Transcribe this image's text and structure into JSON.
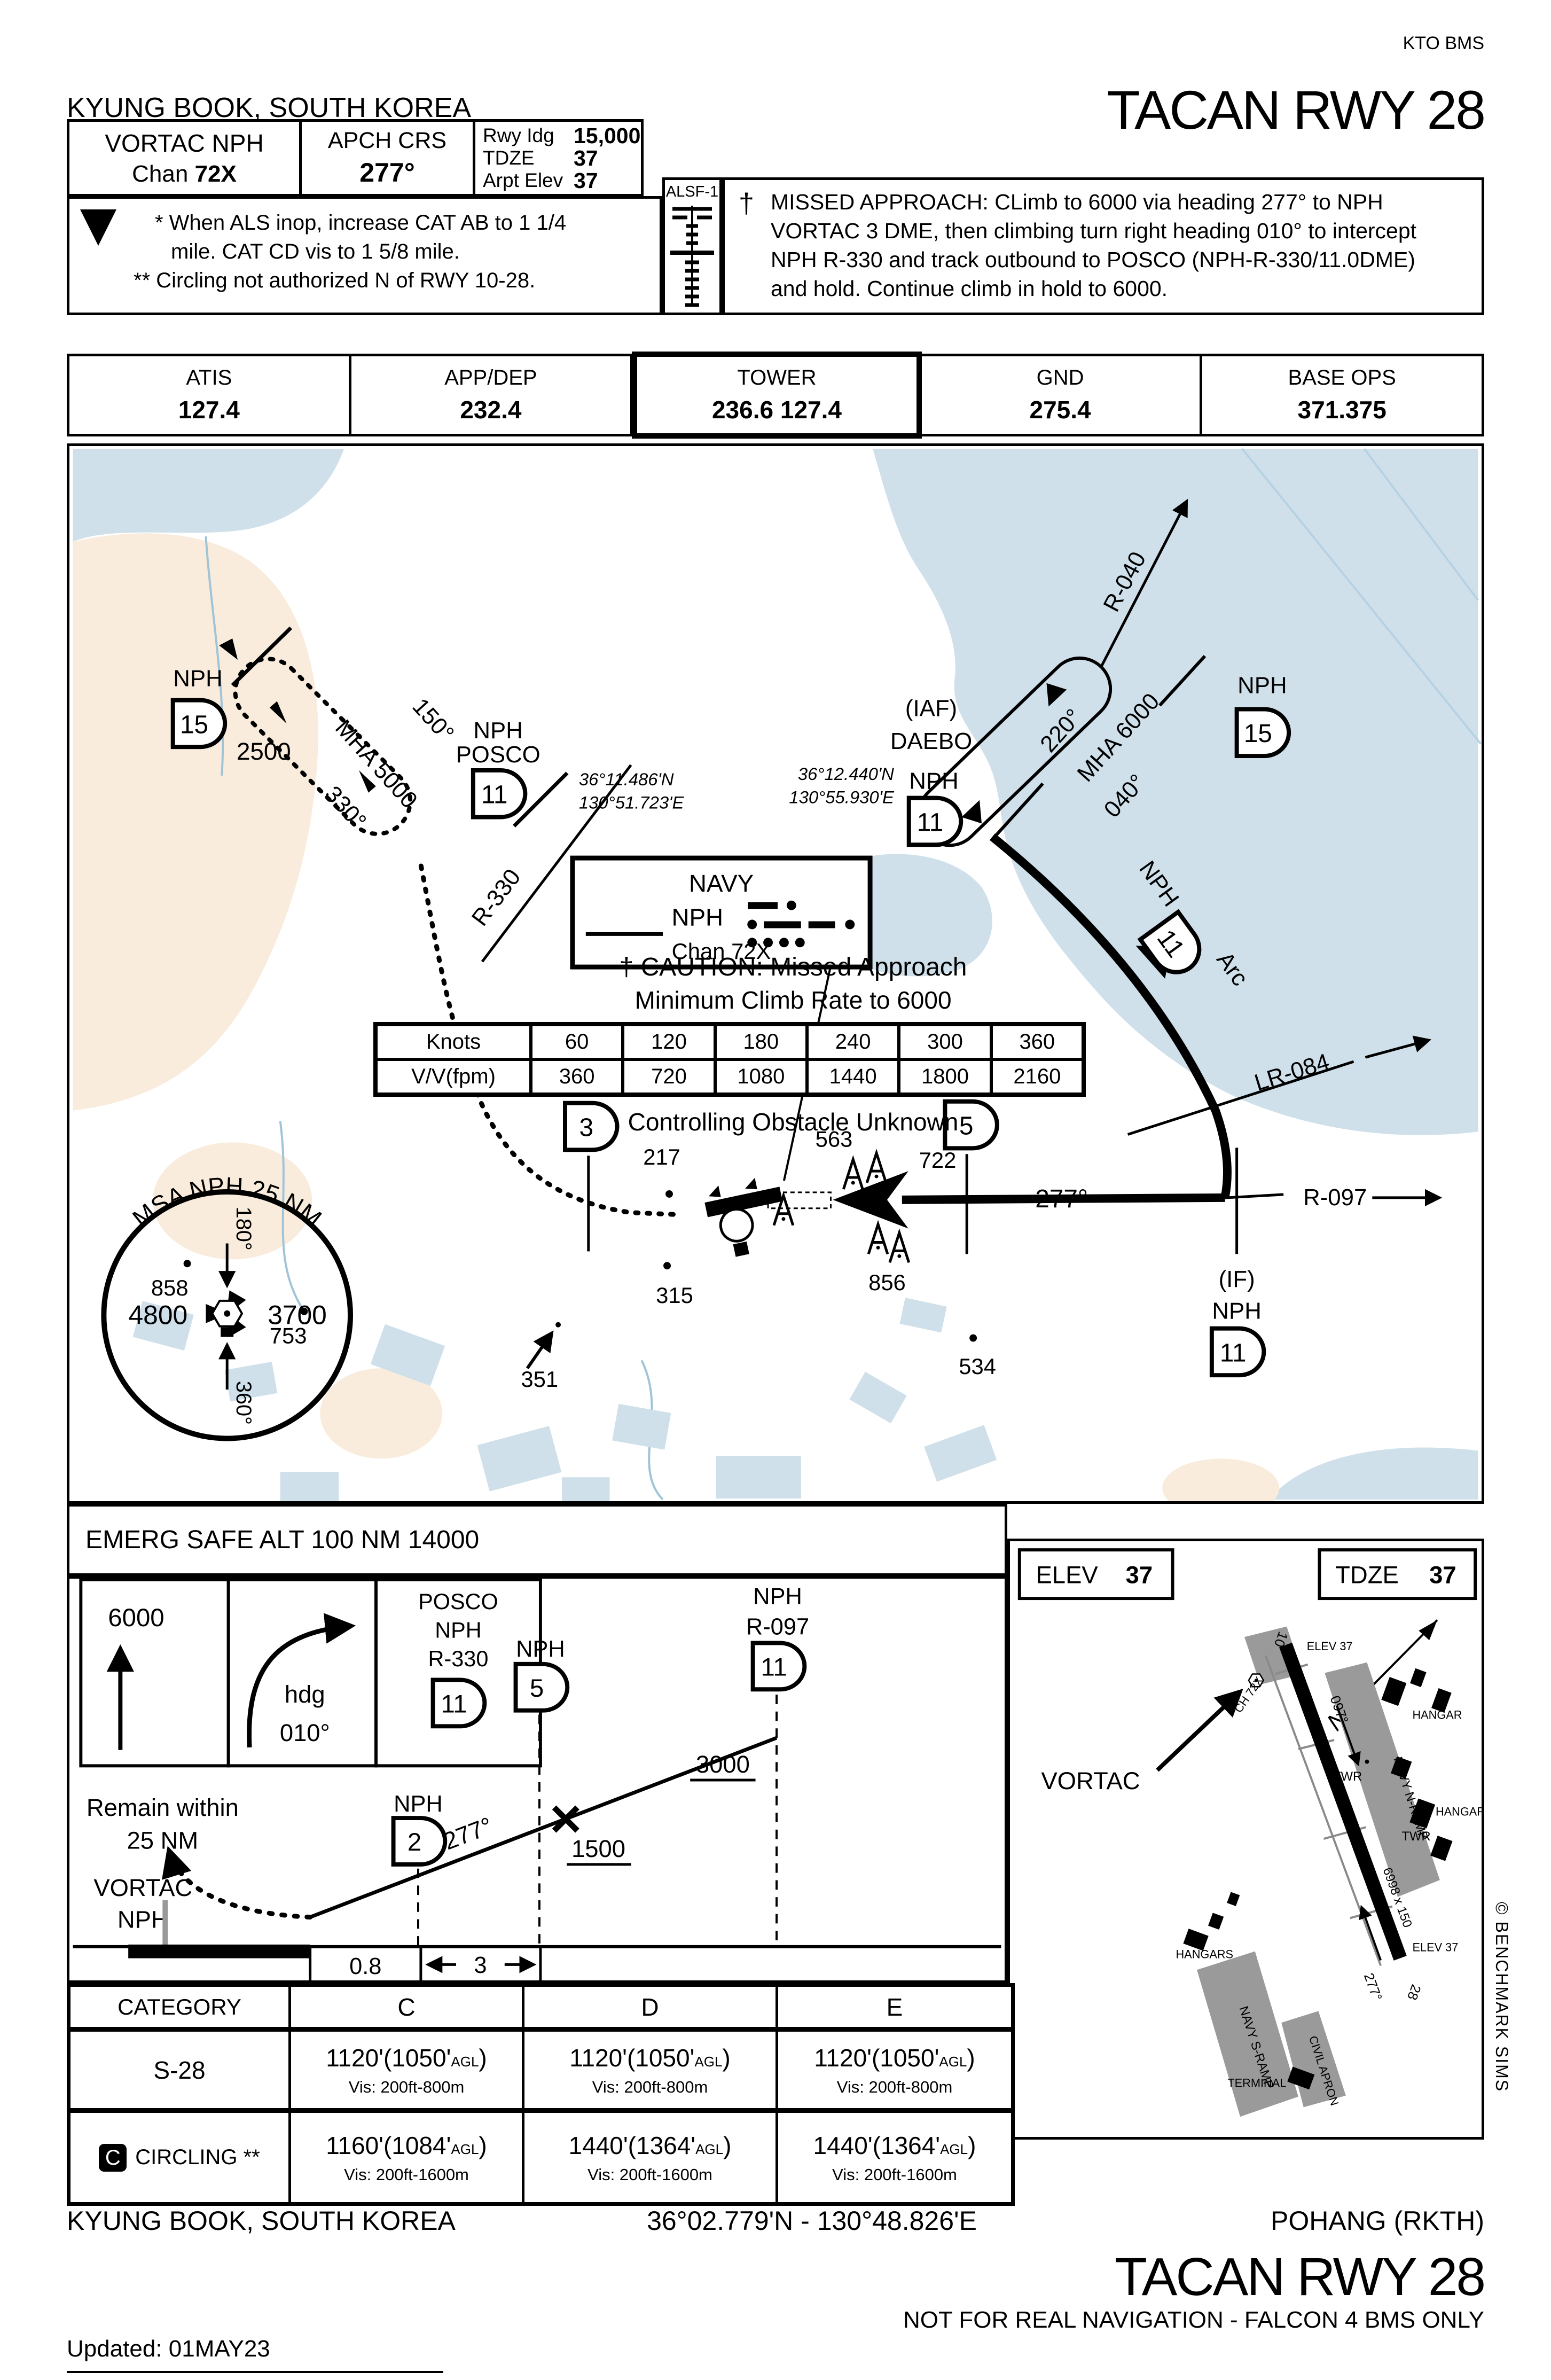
{
  "meta": {
    "kto": "KTO BMS",
    "copyright": "© BENCHMARK SIMS"
  },
  "header": {
    "city": "KYUNG BOOK, SOUTH KOREA",
    "title": "TACAN RWY 28",
    "airport": "POHANG (RKTH)",
    "facility_line1": "VORTAC NPH",
    "chan_label": "Chan",
    "chan_value": "72X",
    "apch_label": "APCH CRS",
    "apch_value": "277°",
    "rwy": {
      "r1l": "Rwy Idg",
      "r1v": "15,000",
      "r2l": "TDZE",
      "r2v": "37",
      "r3l": "Arpt Elev",
      "r3v": "37"
    },
    "notes": {
      "t": "T",
      "n1": "* When ALS inop, increase CAT AB to 1 1/4",
      "n2": "mile. CAT CD vis to 1 5/8 mile.",
      "n3": "** Circling not authorized N of RWY 10-28."
    },
    "alsf": "ALSF-1",
    "missed": {
      "dagger": "†",
      "l1": "MISSED APPROACH: CLimb to 6000 via heading 277° to NPH",
      "l2": "VORTAC 3 DME, then climbing turn right heading 010° to intercept",
      "l3": "NPH R-330 and track outbound to POSCO (NPH-R-330/11.0DME)",
      "l4": "and hold. Continue climb in hold to 6000."
    }
  },
  "freqs": [
    {
      "label": "ATIS",
      "value": "127.4"
    },
    {
      "label": "APP/DEP",
      "value": "232.4"
    },
    {
      "label": "TOWER",
      "value": "236.6   127.4"
    },
    {
      "label": "GND",
      "value": "275.4"
    },
    {
      "label": "BASE OPS",
      "value": "371.375"
    }
  ],
  "plan": {
    "caution1": "† CAUTION: Missed Approach",
    "caution2": "Minimum Climb Rate to 6000",
    "controlling": "Controlling Obstacle Unknown",
    "climb": {
      "knots": [
        "Knots",
        "60",
        "120",
        "180",
        "240",
        "300",
        "360"
      ],
      "vv": [
        "V/V(fpm)",
        "360",
        "720",
        "1080",
        "1440",
        "1800",
        "2160"
      ]
    },
    "holds": {
      "posco": {
        "inb": "150°",
        "mha": "MHA 5000",
        "outb": "330°",
        "alt": "2500"
      },
      "daebo": {
        "inb": "220°",
        "mha": "MHA 6000",
        "outb": "040°"
      }
    },
    "fixes": {
      "nph15L": {
        "name": "NPH",
        "dme": "15"
      },
      "posco": {
        "nph": "NPH",
        "name": "POSCO",
        "dme": "11",
        "lat": "36°11.486'N",
        "lon": "130°51.723'E"
      },
      "daebo": {
        "iaf": "(IAF)",
        "name": "DAEBO",
        "lat": "36°12.440'N",
        "lon": "130°55.930'E",
        "nph": "NPH",
        "dme": "11"
      },
      "nph15R": {
        "name": "NPH",
        "dme": "15"
      },
      "nph3": {
        "name": "NPH",
        "dme": "3"
      },
      "nph5": {
        "name": "NPH",
        "dme": "5"
      },
      "iffix": {
        "tag": "(IF)",
        "nph": "NPH",
        "dme": "11"
      },
      "arc": {
        "nph": "NPH",
        "dme": "11",
        "word": "Arc"
      }
    },
    "radials": {
      "r040": "R-040",
      "r330": "R-330",
      "lr084": "LR-084",
      "r097": "R-097",
      "crs": "277°"
    },
    "navy": {
      "title": "NAVY",
      "id": "NPH",
      "chan": "Chan 72X"
    },
    "msa": {
      "title": "MSA NPH 25 NM",
      "west": "4800",
      "east": "3700",
      "north": "180°",
      "south": "360°"
    },
    "obstacles": {
      "o858": "858",
      "o753": "753",
      "o351": "351",
      "o217": "217",
      "o315": "315",
      "o534": "534",
      "o563": "563",
      "o722": "722",
      "o856": "856"
    },
    "emerg": "EMERG SAFE ALT 100 NM 14000"
  },
  "profile": {
    "alt6000": "6000",
    "hdg1": "hdg",
    "hdg2": "010°",
    "posco1": "POSCO",
    "posco2": "NPH",
    "posco3": "R-330",
    "posco_dme": "11",
    "remain1": "Remain within",
    "remain2": "25 NM",
    "vortac1": "VORTAC",
    "vortac2": "NPH",
    "nph2": {
      "name": "NPH",
      "dme": "2"
    },
    "nph5": {
      "name": "NPH",
      "dme": "5"
    },
    "r097fix": {
      "name": "NPH",
      "radial": "R-097",
      "dme": "11"
    },
    "alt3000": "3000",
    "alt1500": "1500",
    "crs": "277°",
    "dist1": "0.8",
    "dist2": "3"
  },
  "sketch": {
    "elev_label": "ELEV",
    "elev_value": "37",
    "tdze_label": "TDZE",
    "tdze_value": "37",
    "vortac": "VORTAC",
    "north": "N",
    "ch": "CH 72X",
    "rw10": "10",
    "rw28": "28",
    "elev37": "ELEV 37",
    "c097": "097°",
    "c277": "277°",
    "twr": "TWR",
    "hangar": "HANGAR",
    "hangars": "HANGARS",
    "nramp": "NAVY N-RAMP",
    "sramp": "NAVY S-RAMP",
    "apron": "CIVIL APRON",
    "terminal": "TERMINAL",
    "dims": "6998 x 150"
  },
  "minimums": {
    "header": [
      "CATEGORY",
      "C",
      "D",
      "E"
    ],
    "s28": {
      "cat": "S-28",
      "c": {
        "alt": "1120'(1050'",
        "agl": "AGL",
        "close": ")",
        "vis": "Vis: 200ft-800m"
      },
      "d": {
        "alt": "1120'(1050'",
        "agl": "AGL",
        "close": ")",
        "vis": "Vis: 200ft-800m"
      },
      "e": {
        "alt": "1120'(1050'",
        "agl": "AGL",
        "close": ")",
        "vis": "Vis: 200ft-800m"
      }
    },
    "circling": {
      "icon": "C",
      "cat": "CIRCLING **",
      "c": {
        "alt": "1160'(1084'",
        "agl": "AGL",
        "close": ")",
        "vis": "Vis: 200ft-1600m"
      },
      "d": {
        "alt": "1440'(1364'",
        "agl": "AGL",
        "close": ")",
        "vis": "Vis: 200ft-1600m"
      },
      "e": {
        "alt": "1440'(1364'",
        "agl": "AGL",
        "close": ")",
        "vis": "Vis: 200ft-1600m"
      }
    }
  },
  "footer": {
    "city": "KYUNG BOOK, SOUTH KOREA",
    "coords": "36°02.779'N - 130°48.826'E",
    "airport": "POHANG (RKTH)",
    "title": "TACAN RWY 28",
    "disclaimer": "NOT FOR REAL NAVIGATION - FALCON 4 BMS ONLY",
    "updated": "Updated: 01MAY23"
  }
}
